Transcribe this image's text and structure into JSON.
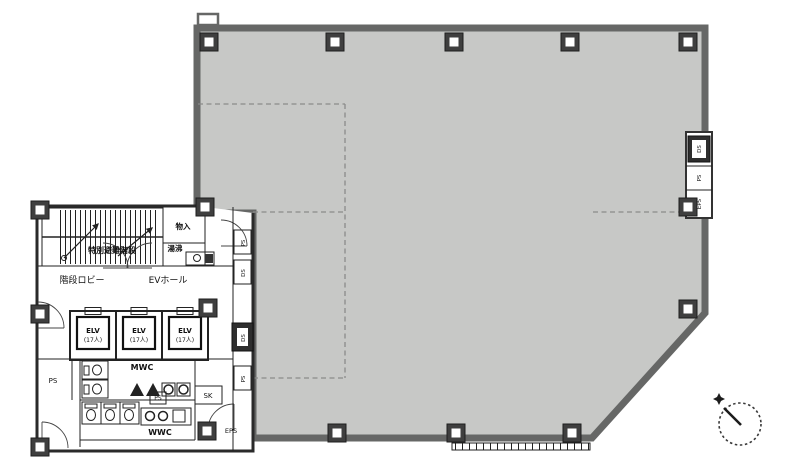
{
  "plan": {
    "labels": {
      "special_evacuation_stairs": "特別避難階段",
      "stair_lobby": "階段ロビー",
      "elevator_hall": "EVホール",
      "storage": "物入",
      "hot_water": "湯沸",
      "mens_wc": "MWC",
      "womens_wc": "WWC",
      "pipe_space": "PS",
      "duct_space": "DS",
      "electrical_pipe_space": "EPS",
      "slop_sink": "SK"
    },
    "elevators": [
      {
        "name": "ELV",
        "capacity": "(17人)"
      },
      {
        "name": "ELV",
        "capacity": "(17人)"
      },
      {
        "name": "ELV",
        "capacity": "(17人)"
      }
    ],
    "colors": {
      "office_fill": "#c7c8c6",
      "perimeter_wall": "#666766",
      "core_line": "#2a2a2a",
      "lease_line": "#8a8a8a"
    }
  }
}
